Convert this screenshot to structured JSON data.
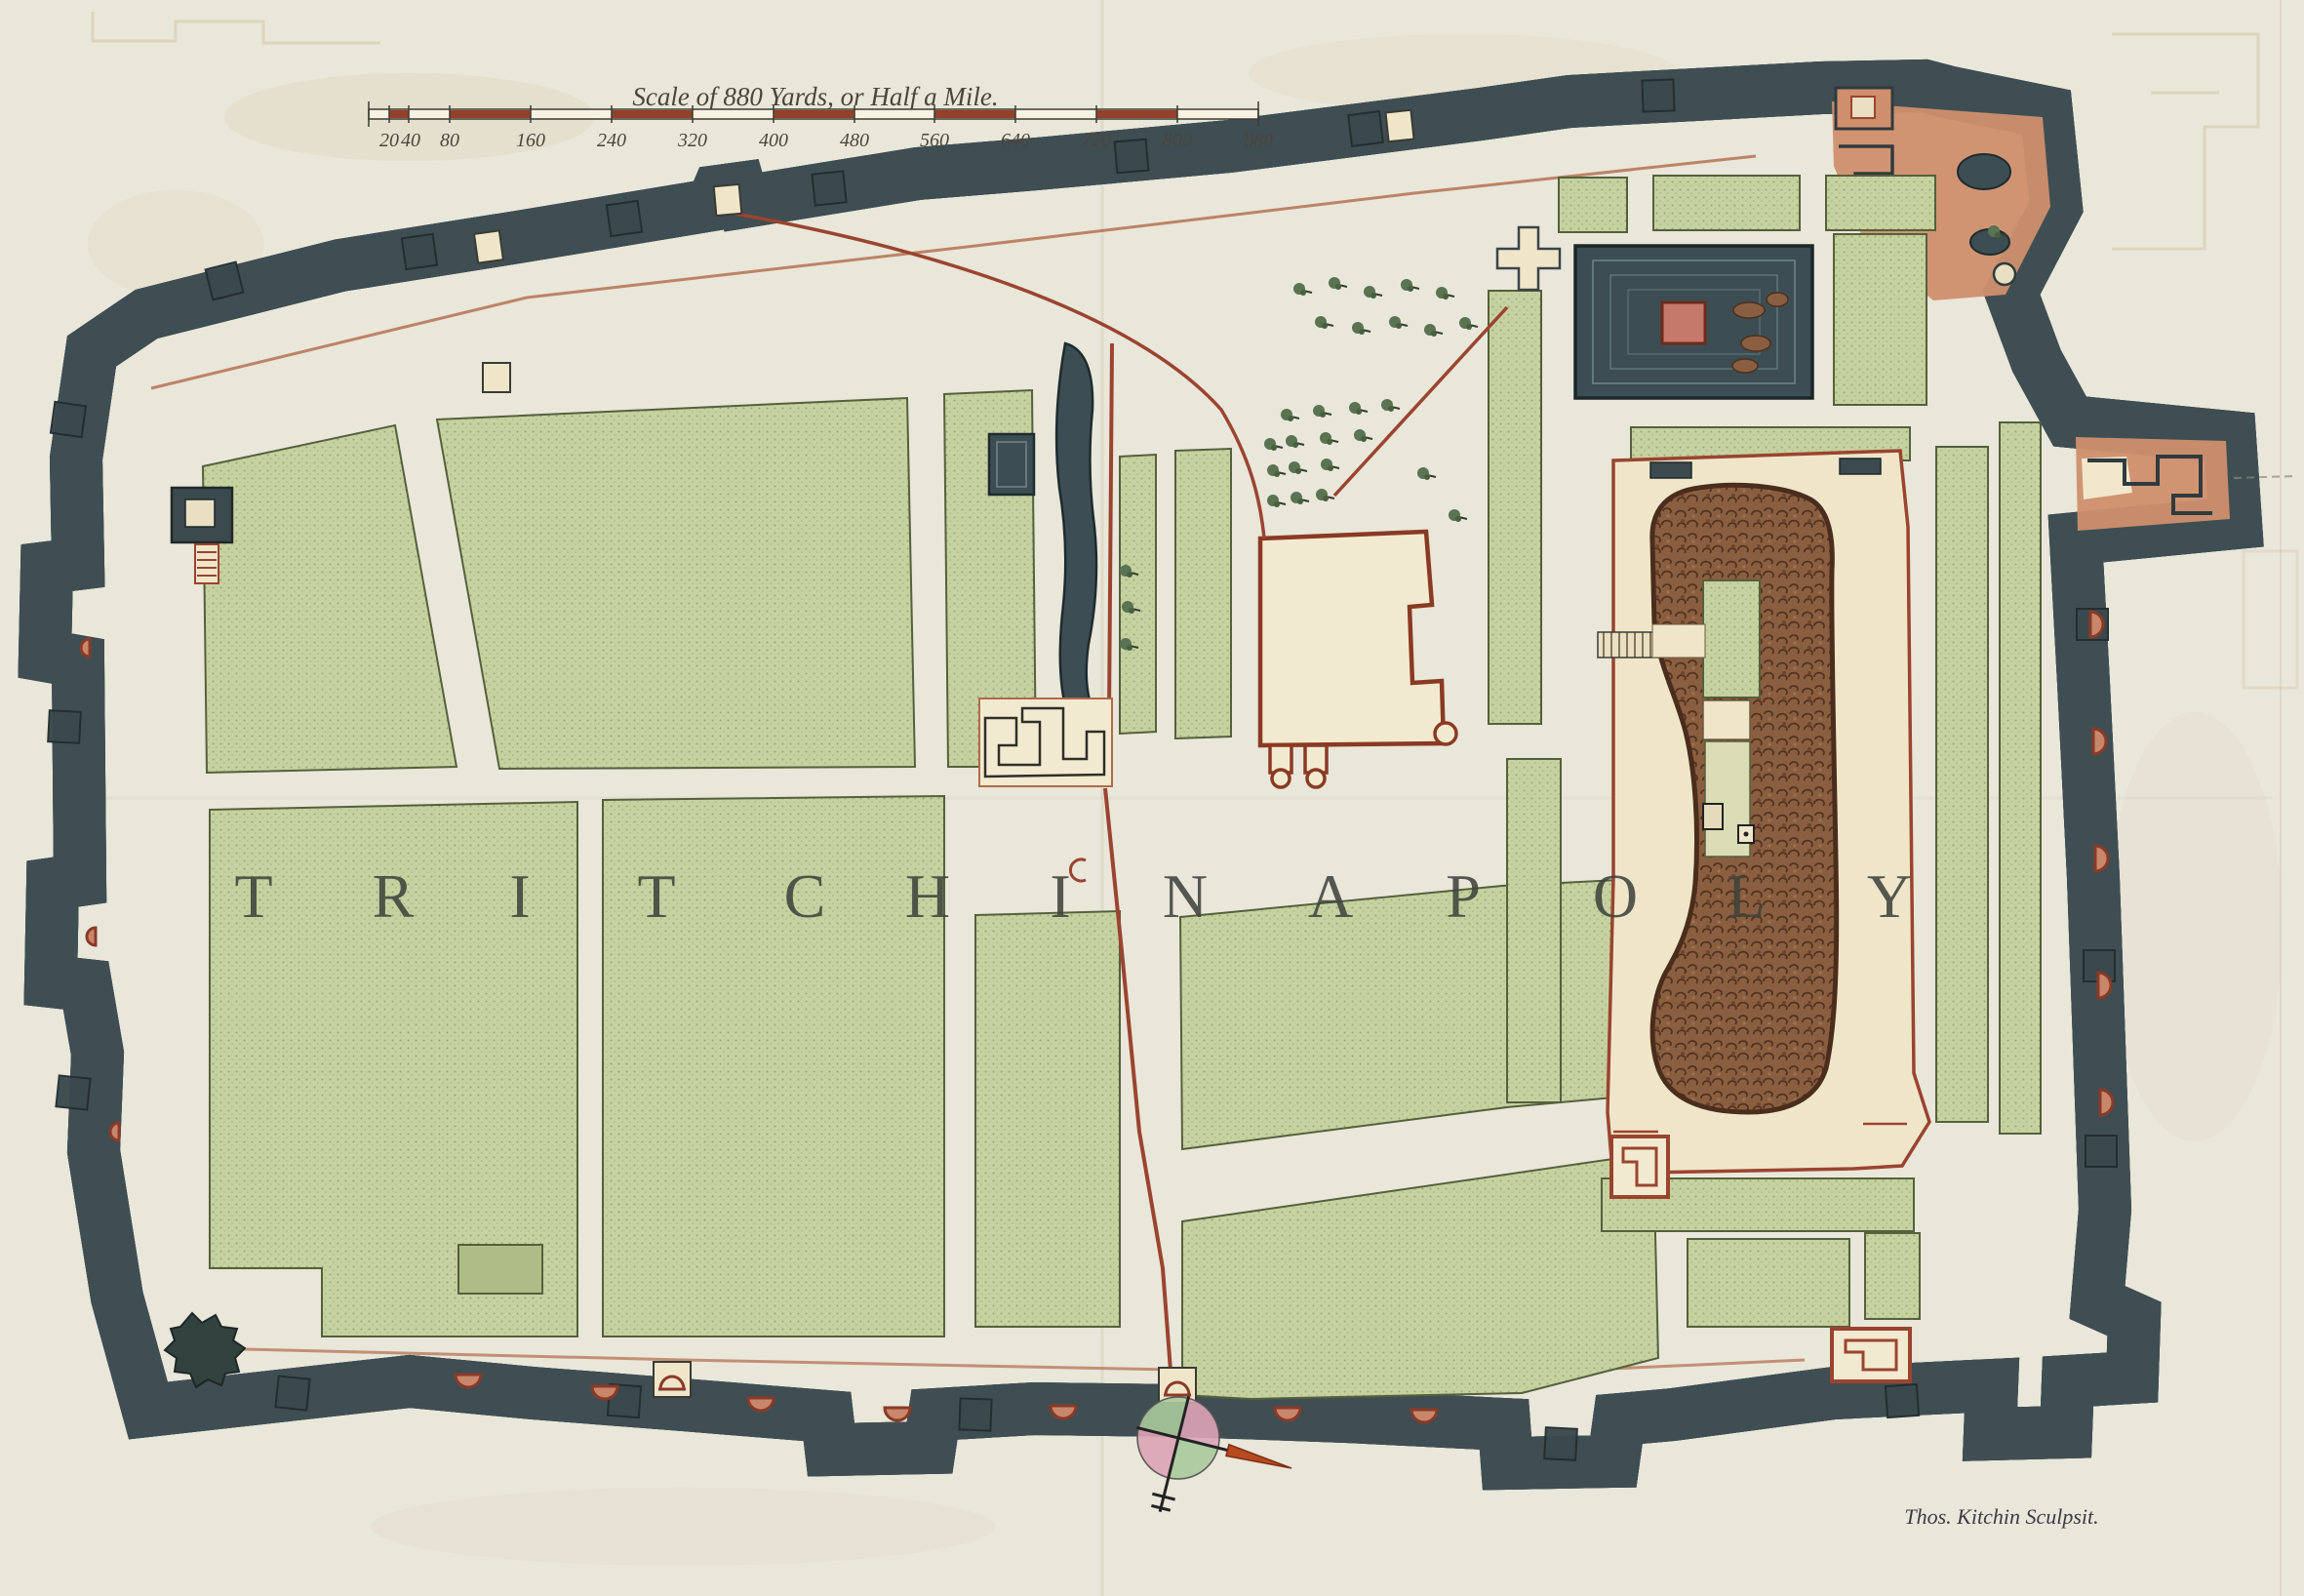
{
  "map": {
    "scale_bar": {
      "title": "Scale of 880 Yards, or Half a Mile.",
      "tick_labels": [
        "20",
        "40",
        "80",
        "160",
        "240",
        "320",
        "400",
        "480",
        "560",
        "640",
        "720",
        "800",
        "880"
      ]
    },
    "city_name": "TRITCHINAPOLY",
    "city_letters": [
      "T",
      "R",
      "I",
      "T",
      "C",
      "H",
      "I",
      "N",
      "A",
      "P",
      "O",
      "L",
      "Y"
    ],
    "signature": "Thos. Kitchin Sculpsit.",
    "colors": {
      "paper": "#e9e6da",
      "ground": "#f0e7cc",
      "wall_dark": "#3f4f54",
      "rampart_salmon": "#c8876b",
      "field_green": "#c6d1a0",
      "water_dark": "#3c4e53",
      "rock_brown": "#8a5f41",
      "island_red": "#c4796a",
      "scale_red": "#93412a",
      "road_red": "#9a4430",
      "compass_pink": "#dca3b6",
      "compass_green": "#a9c99b"
    },
    "features": [
      "city-wall",
      "rampart",
      "bastions",
      "temple-tank",
      "tank-island",
      "rock-fort",
      "fort-enclosure",
      "palace-compound",
      "pond",
      "trees",
      "street-grid",
      "gates",
      "compass-rose",
      "scale-bar",
      "engraver-signature"
    ]
  }
}
